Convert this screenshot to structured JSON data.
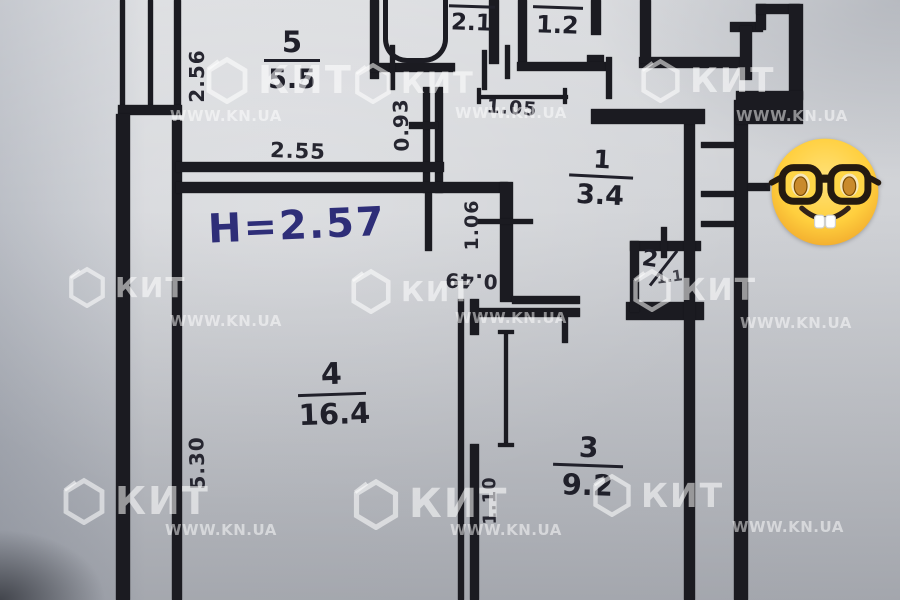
{
  "floor_plan": {
    "ceiling_height_label": "H=2.57",
    "rooms": [
      {
        "number": "5",
        "area": "5.5"
      },
      {
        "number": "",
        "area": "2.1"
      },
      {
        "number": "7",
        "area": "1.2"
      },
      {
        "number": "1",
        "area": "3.4"
      },
      {
        "number": "2",
        "area": "1.1"
      },
      {
        "number": "4",
        "area": "16.4"
      },
      {
        "number": "3",
        "area": "9.2"
      }
    ],
    "dimensions": {
      "kitchen_left_wall": "2.56",
      "kitchen_bottom_wall": "2.55",
      "kitchen_doorway": "0.93",
      "corridor_width": "1.05",
      "hall_doorway": "1.06",
      "niche_width": "0.49",
      "room4_left_wall": "5.30",
      "room3_doorway": "1.10"
    }
  },
  "watermark": {
    "brand": "КИТ",
    "site": "WWW.KN.UA"
  },
  "sticker": {
    "emoji": "nerd-face"
  }
}
